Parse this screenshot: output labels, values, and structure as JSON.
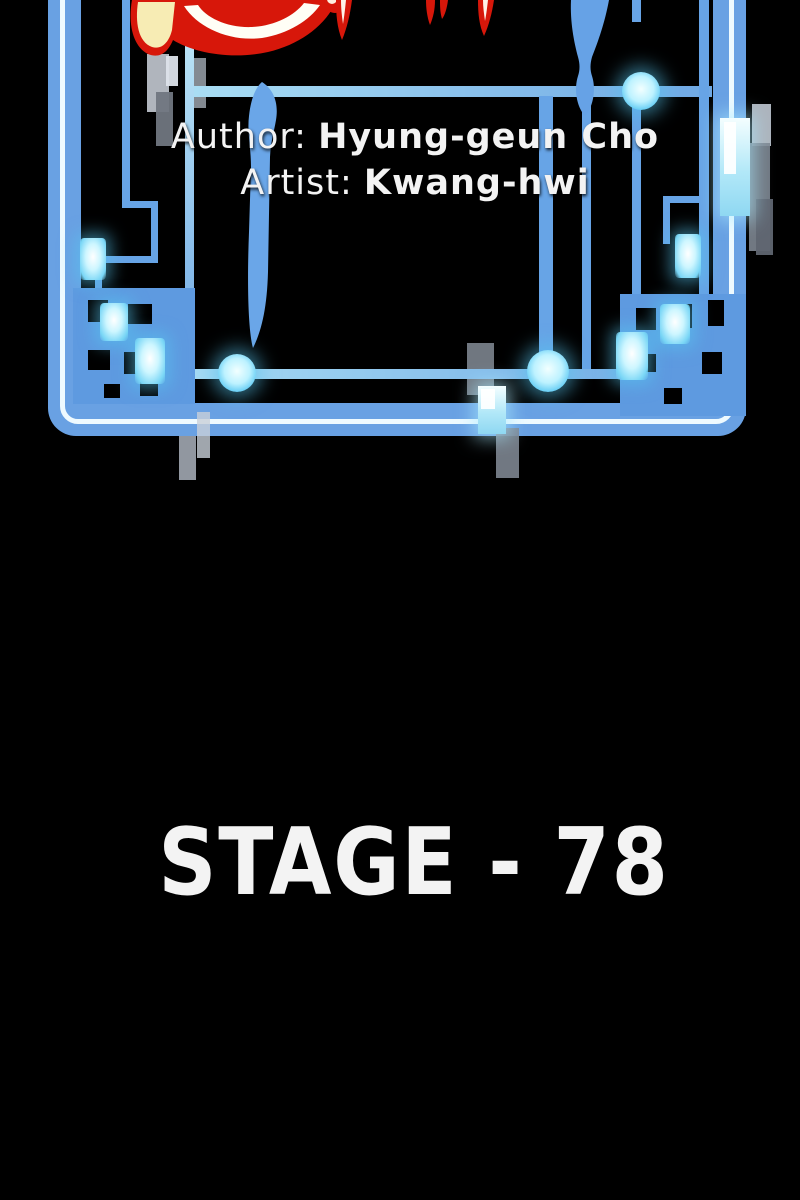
{
  "credits": {
    "author_label": "Author:",
    "author_name": "Hyung-geun Cho",
    "artist_label": "Artist:",
    "artist_name": "Kwang-hwi"
  },
  "stage": {
    "title": "STAGE - 78"
  },
  "colors": {
    "background": "#000000",
    "frame_blue": "#69a1e3",
    "frame_stripe": "#eefaff",
    "line_blue": "#67a4e6",
    "line_cyan": "#93d4f3",
    "cluster_blue": "#5e9ae0",
    "glow_cyan": "#aeefff",
    "glow_halo": "#58c6f0",
    "flame_red": "#d7170a",
    "flame_cream": "#f7ecb4",
    "flame_white": "#fffef6",
    "panel_gray": "#9aa2ac",
    "text_white": "#f3f3f3"
  }
}
